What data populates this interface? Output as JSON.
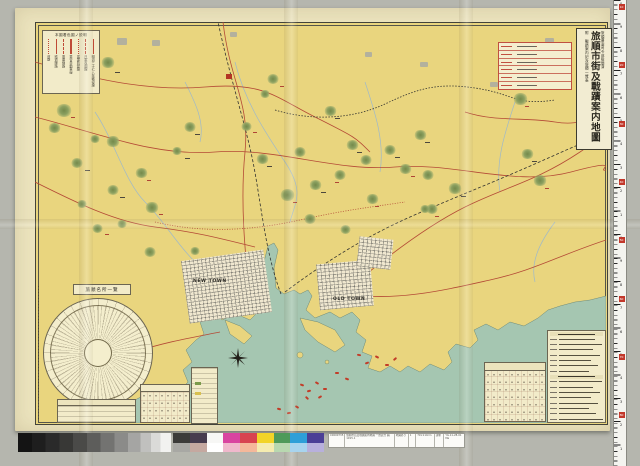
{
  "title_block": {
    "approval": "旅順要塞司令部檢閲濟",
    "title": "旅順市街及戰蹟案内地圖",
    "subtitle": "附 戰蹟案内記及旅順一覽表"
  },
  "legend": {
    "title": "本圖着色圖ノ説明",
    "items": [
      {
        "label": "明治三十七八年戰役線",
        "style": "solid"
      },
      {
        "label": "日軍攻圍線",
        "style": "dashed"
      },
      {
        "label": "露軍防禦線",
        "style": "dotted"
      },
      {
        "label": "乘合自動車線",
        "style": "double"
      },
      {
        "label": "電車線路",
        "style": "dashed"
      },
      {
        "label": "鐵道線路",
        "style": "solid"
      },
      {
        "label": "道路",
        "style": "dotted"
      }
    ]
  },
  "map_labels": {
    "new_town": "NEW TOWN",
    "old_town": "OLD TOWN"
  },
  "wheel": {
    "header": "旅順名所一覽",
    "caption_rows": 4
  },
  "tables": {
    "distance_rows": 6,
    "list_rows": 17,
    "list_header_rows": [
      0,
      8
    ]
  },
  "catalog_label": {
    "cells": [
      "C0000735",
      "旅順市街及戰蹟案内地圖 一覽表含 圖, 1915.1",
      "地圖あり",
      "1",
      "79×110cm",
      "請求",
      "YG.11-28-01 Ma"
    ]
  },
  "ruler": {
    "digits": "0987654321",
    "red_labels": [
      "10",
      "20",
      "30",
      "40",
      "50",
      "60",
      "70",
      "80"
    ]
  },
  "palette": {
    "top": [
      "#3b3b39",
      "#473b4e",
      "#f7f7f5",
      "#d944a0",
      "#d84350",
      "#f2d428",
      "#4e9a5a",
      "#2e9fd8",
      "#4b3f96"
    ],
    "bottom": [
      "#a8a8a4",
      "#c5a8a0",
      "#ffffff",
      "#f0b8cc",
      "#f5b89a",
      "#f5ecb0",
      "#b8d8b0",
      "#a8d4ee",
      "#b8b0dc"
    ]
  },
  "colors": {
    "paper": "#ebe3bd",
    "land": "#e9d57e",
    "sea": "#a5c6b1",
    "road_red": "#b44a36",
    "rail_black": "#333330",
    "stream_blue": "#9fb9c9",
    "mountain_green": "#8ba060",
    "scanner_bg": "#b5b6ae"
  },
  "mountains": [
    [
      73,
      42,
      14
    ],
    [
      29,
      90,
      16
    ],
    [
      19,
      107,
      13
    ],
    [
      42,
      142,
      12
    ],
    [
      78,
      121,
      14
    ],
    [
      106,
      152,
      13
    ],
    [
      78,
      169,
      12
    ],
    [
      117,
      187,
      14
    ],
    [
      62,
      207,
      11
    ],
    [
      47,
      183,
      10
    ],
    [
      155,
      106,
      12
    ],
    [
      211,
      105,
      11
    ],
    [
      238,
      58,
      12
    ],
    [
      227,
      138,
      13
    ],
    [
      252,
      174,
      15
    ],
    [
      265,
      131,
      12
    ],
    [
      280,
      164,
      13
    ],
    [
      295,
      90,
      13
    ],
    [
      305,
      154,
      12
    ],
    [
      317,
      124,
      13
    ],
    [
      331,
      139,
      12
    ],
    [
      337,
      178,
      13
    ],
    [
      355,
      129,
      12
    ],
    [
      370,
      148,
      13
    ],
    [
      385,
      114,
      13
    ],
    [
      393,
      154,
      12
    ],
    [
      397,
      188,
      12
    ],
    [
      420,
      168,
      14
    ],
    [
      390,
      188,
      10
    ],
    [
      275,
      198,
      12
    ],
    [
      310,
      208,
      11
    ],
    [
      485,
      78,
      15
    ],
    [
      492,
      133,
      13
    ],
    [
      505,
      160,
      14
    ],
    [
      230,
      73,
      10
    ],
    [
      142,
      130,
      10
    ],
    [
      60,
      118,
      10
    ],
    [
      115,
      231,
      12
    ],
    [
      87,
      203,
      10
    ],
    [
      160,
      230,
      10
    ]
  ],
  "ships": [
    [
      265,
      362,
      20
    ],
    [
      272,
      368,
      -15
    ],
    [
      280,
      360,
      30
    ],
    [
      288,
      366,
      0
    ],
    [
      270,
      375,
      45
    ],
    [
      283,
      374,
      -30
    ],
    [
      322,
      332,
      10
    ],
    [
      330,
      340,
      -20
    ],
    [
      340,
      334,
      25
    ],
    [
      350,
      342,
      0
    ],
    [
      358,
      336,
      -40
    ],
    [
      242,
      386,
      15
    ],
    [
      252,
      390,
      -10
    ],
    [
      260,
      384,
      30
    ],
    [
      300,
      350,
      0
    ],
    [
      310,
      356,
      20
    ]
  ],
  "specks": [
    [
      80,
      50,
      5,
      "k"
    ],
    [
      36,
      95,
      4,
      "r"
    ],
    [
      50,
      148,
      5,
      "k"
    ],
    [
      112,
      158,
      4,
      "r"
    ],
    [
      85,
      175,
      5,
      "k"
    ],
    [
      124,
      192,
      4,
      "r"
    ],
    [
      160,
      112,
      5,
      "k"
    ],
    [
      218,
      110,
      4,
      "r"
    ],
    [
      232,
      144,
      5,
      "k"
    ],
    [
      258,
      180,
      4,
      "r"
    ],
    [
      286,
      170,
      5,
      "k"
    ],
    [
      300,
      160,
      4,
      "r"
    ],
    [
      322,
      130,
      5,
      "k"
    ],
    [
      340,
      184,
      4,
      "r"
    ],
    [
      360,
      135,
      5,
      "k"
    ],
    [
      376,
      154,
      4,
      "r"
    ],
    [
      390,
      120,
      5,
      "k"
    ],
    [
      400,
      194,
      4,
      "r"
    ],
    [
      426,
      174,
      5,
      "k"
    ],
    [
      490,
      84,
      4,
      "r"
    ],
    [
      497,
      139,
      5,
      "k"
    ],
    [
      510,
      166,
      4,
      "r"
    ],
    [
      300,
      96,
      5,
      "k"
    ],
    [
      245,
      64,
      4,
      "r"
    ],
    [
      150,
      136,
      5,
      "k"
    ],
    [
      70,
      212,
      4,
      "r"
    ]
  ],
  "patches": [
    [
      82,
      16,
      10,
      7
    ],
    [
      117,
      18,
      8,
      6
    ],
    [
      195,
      10,
      7,
      5
    ],
    [
      510,
      16,
      9,
      6
    ],
    [
      385,
      40,
      8,
      5
    ],
    [
      330,
      30,
      7,
      5
    ],
    [
      455,
      60,
      8,
      5
    ],
    [
      40,
      60,
      7,
      5
    ]
  ],
  "red_square": [
    191,
    52,
    6,
    5
  ]
}
